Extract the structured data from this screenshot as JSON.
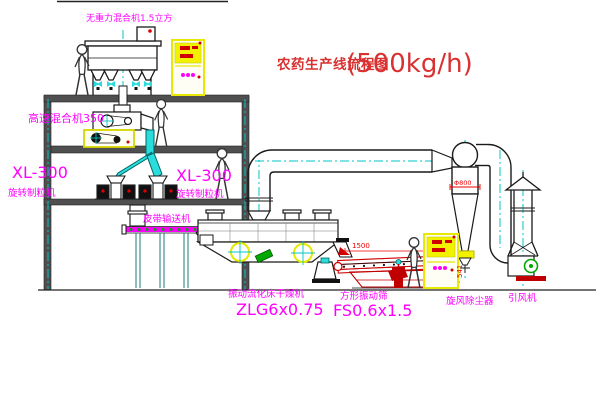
{
  "title": {
    "name": "农药生产线流程图",
    "capacity": "(500kg/h)"
  },
  "labels": {
    "zero_gravity_mixer": "无重力混合机1.5立方",
    "high_speed_mixer": "高速混合机350",
    "granulator_left_model": "XL-300",
    "granulator_left_name": "旋转制粒机",
    "granulator_right_model": "XL-300",
    "granulator_right_name": "旋转制粒机",
    "belt_conveyor": "皮带输送机",
    "dryer_name": "振动流化床干燥机",
    "dryer_model": "ZLG6x0.75",
    "sieve_name": "方形振动筛",
    "sieve_model": "FS0.6x1.5",
    "cyclone_name": "旋风除尘器",
    "fan_name": "引风机"
  },
  "dimensions": {
    "sieve_length": "1500",
    "sieve_height": "541",
    "cyclone_diameter": "Φ800"
  },
  "colors": {
    "label_magenta": "#ff00ff",
    "title_red": "#d93030",
    "dimension_red": "#ee0000",
    "centerline_cyan": "#00c4c4",
    "cad_yellow": "#f2f200",
    "detail_green": "#00a800",
    "structure_gray": "#4f4f4f"
  }
}
